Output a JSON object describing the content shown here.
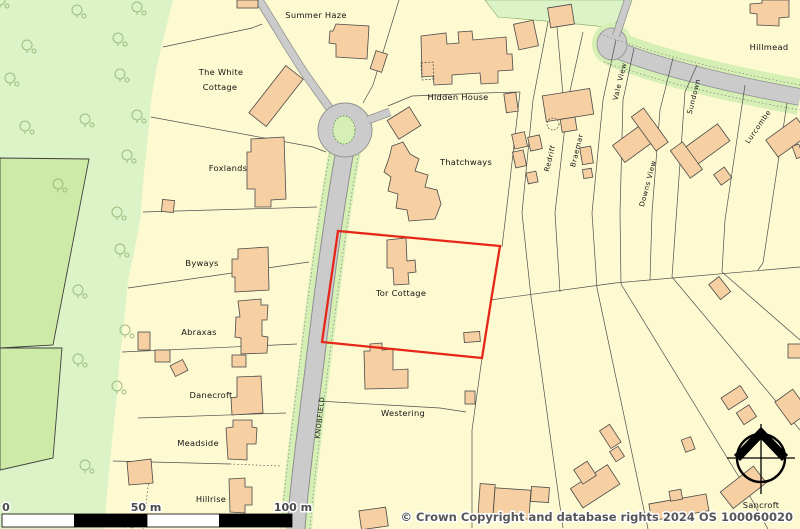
{
  "map": {
    "title": "OS site location plan",
    "property_labels": {
      "summer_haze": "Summer Haze",
      "white_cottage_line1": "The White",
      "white_cottage_line2": "Cottage",
      "hidden_house": "Hidden House",
      "thatchways": "Thatchways",
      "hillmead": "Hillmead",
      "foxlands": "Foxlands",
      "byways": "Byways",
      "abraxas": "Abraxas",
      "danecroft": "Danecroft",
      "meadside": "Meadside",
      "hillrise": "Hillrise",
      "westering": "Westering",
      "tor_cottage": "Tor Cottage",
      "sancroft": "Sancroft"
    },
    "road_labels": {
      "knobfield": "KNOBFIELD",
      "redriff": "Redriff",
      "braemar": "Braemar",
      "vale_view": "Vale View",
      "downs_view": "Downs View",
      "sundown": "Sundown",
      "lurcombe": "Lurcombe"
    },
    "highlight": {
      "plot_name": "Tor Cottage",
      "boundary_color": "#e62617"
    },
    "scale_bar": {
      "tick_0": "0",
      "tick_50": "50 m",
      "tick_100": "100 m"
    },
    "copyright": "© Crown Copyright and database rights 2024 OS 100060020",
    "colors": {
      "background": "#fdf9d0",
      "woodland": "#dbf3c6",
      "field": "#cdeba6",
      "road_fill": "#cbcbcb",
      "road_casing": "#8f8f8f",
      "verge": "#d6efb5",
      "building_fill": "#f6cfa3",
      "building_stroke": "#4a4a4a",
      "boundary_line": "#4f4f4f",
      "highlight_red": "#e62617"
    }
  }
}
